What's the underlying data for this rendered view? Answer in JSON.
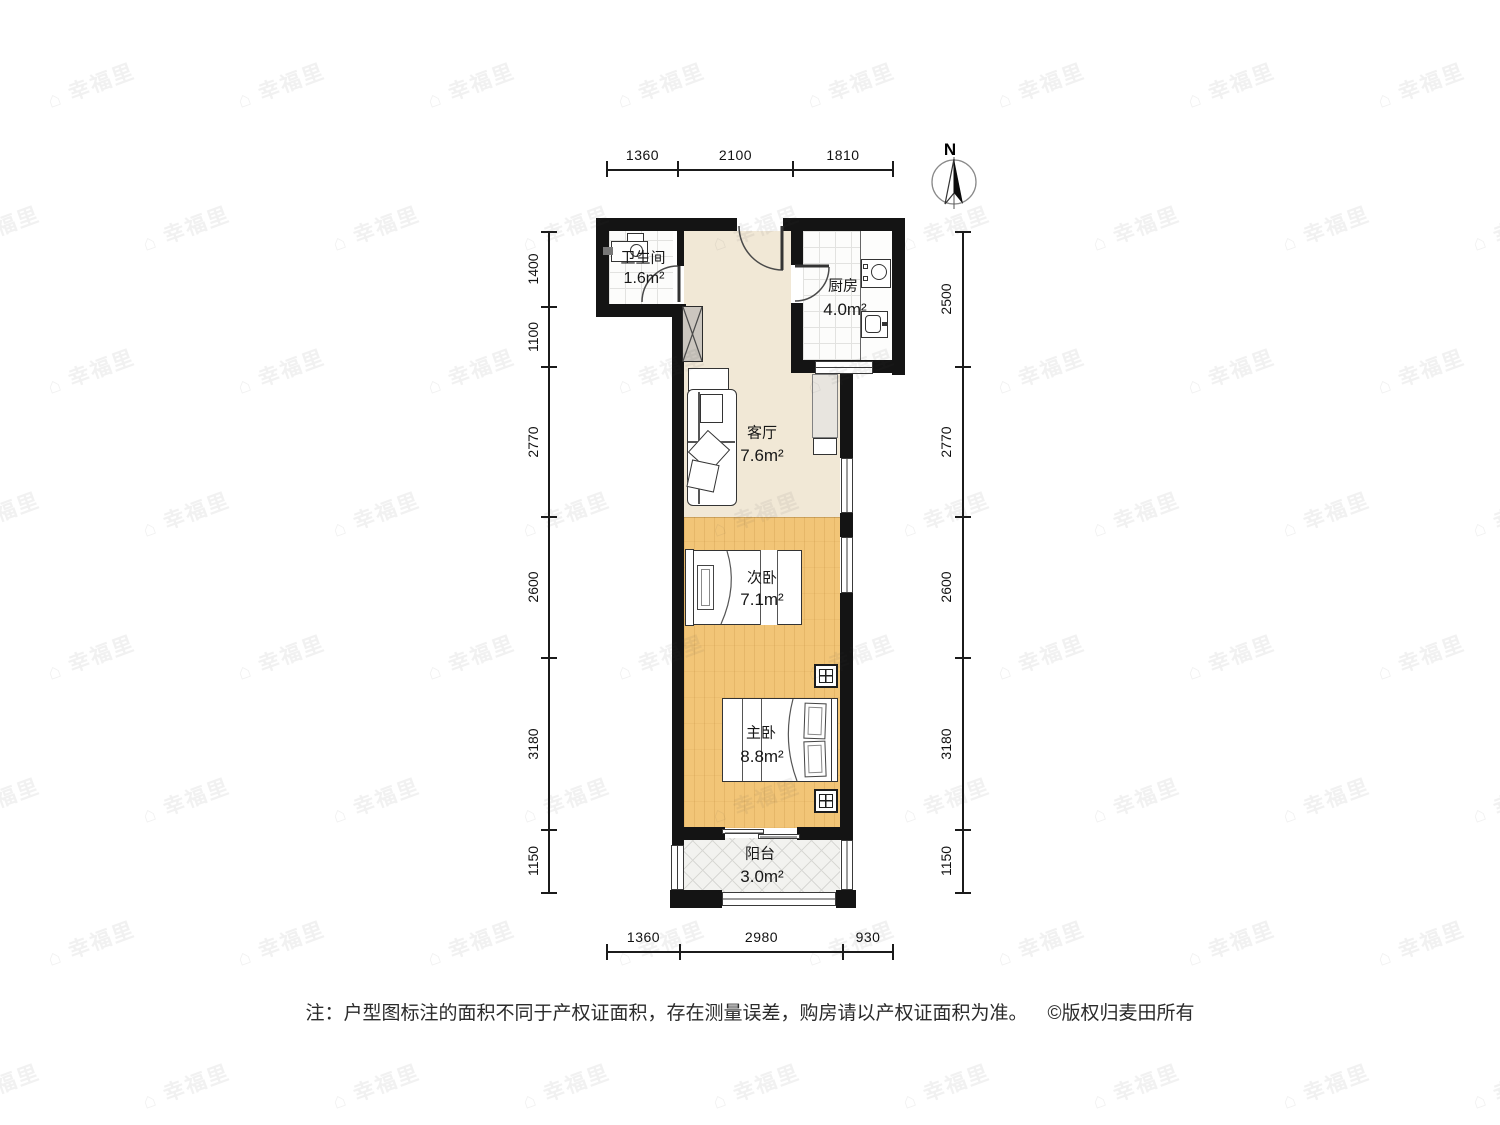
{
  "compass": {
    "north_label": "N"
  },
  "watermark": {
    "icon": "⌂",
    "text": "幸福里"
  },
  "rooms": {
    "bathroom": {
      "name": "卫生间",
      "area": "1.6m²"
    },
    "kitchen": {
      "name": "厨房",
      "area": "4.0m²"
    },
    "living": {
      "name": "客厅",
      "area": "7.6m²"
    },
    "bedroom2": {
      "name": "次卧",
      "area": "7.1m²"
    },
    "bedroom1": {
      "name": "主卧",
      "area": "8.8m²"
    },
    "balcony": {
      "name": "阳台",
      "area": "3.0m²"
    }
  },
  "dimensions": {
    "top": [
      "1360",
      "2100",
      "1810"
    ],
    "bottom": [
      "1360",
      "2980",
      "930"
    ],
    "left": [
      "1400",
      "1100",
      "2770",
      "2600",
      "3180",
      "1150"
    ],
    "right": [
      "2500",
      "2770",
      "2600",
      "3180",
      "1150"
    ]
  },
  "footer": {
    "note": "注：户型图标注的面积不同于产权证面积，存在测量误差，购房请以产权证面积为准。",
    "copyright": "©版权归麦田所有"
  },
  "colors": {
    "wall": "#141414",
    "floor_living": "#f1e8d6",
    "floor_bedroom": "#f2c577",
    "floor_tile": "#fcfcfb",
    "floor_balcony": "#f2f2ef",
    "dimension_text": "#111111"
  }
}
